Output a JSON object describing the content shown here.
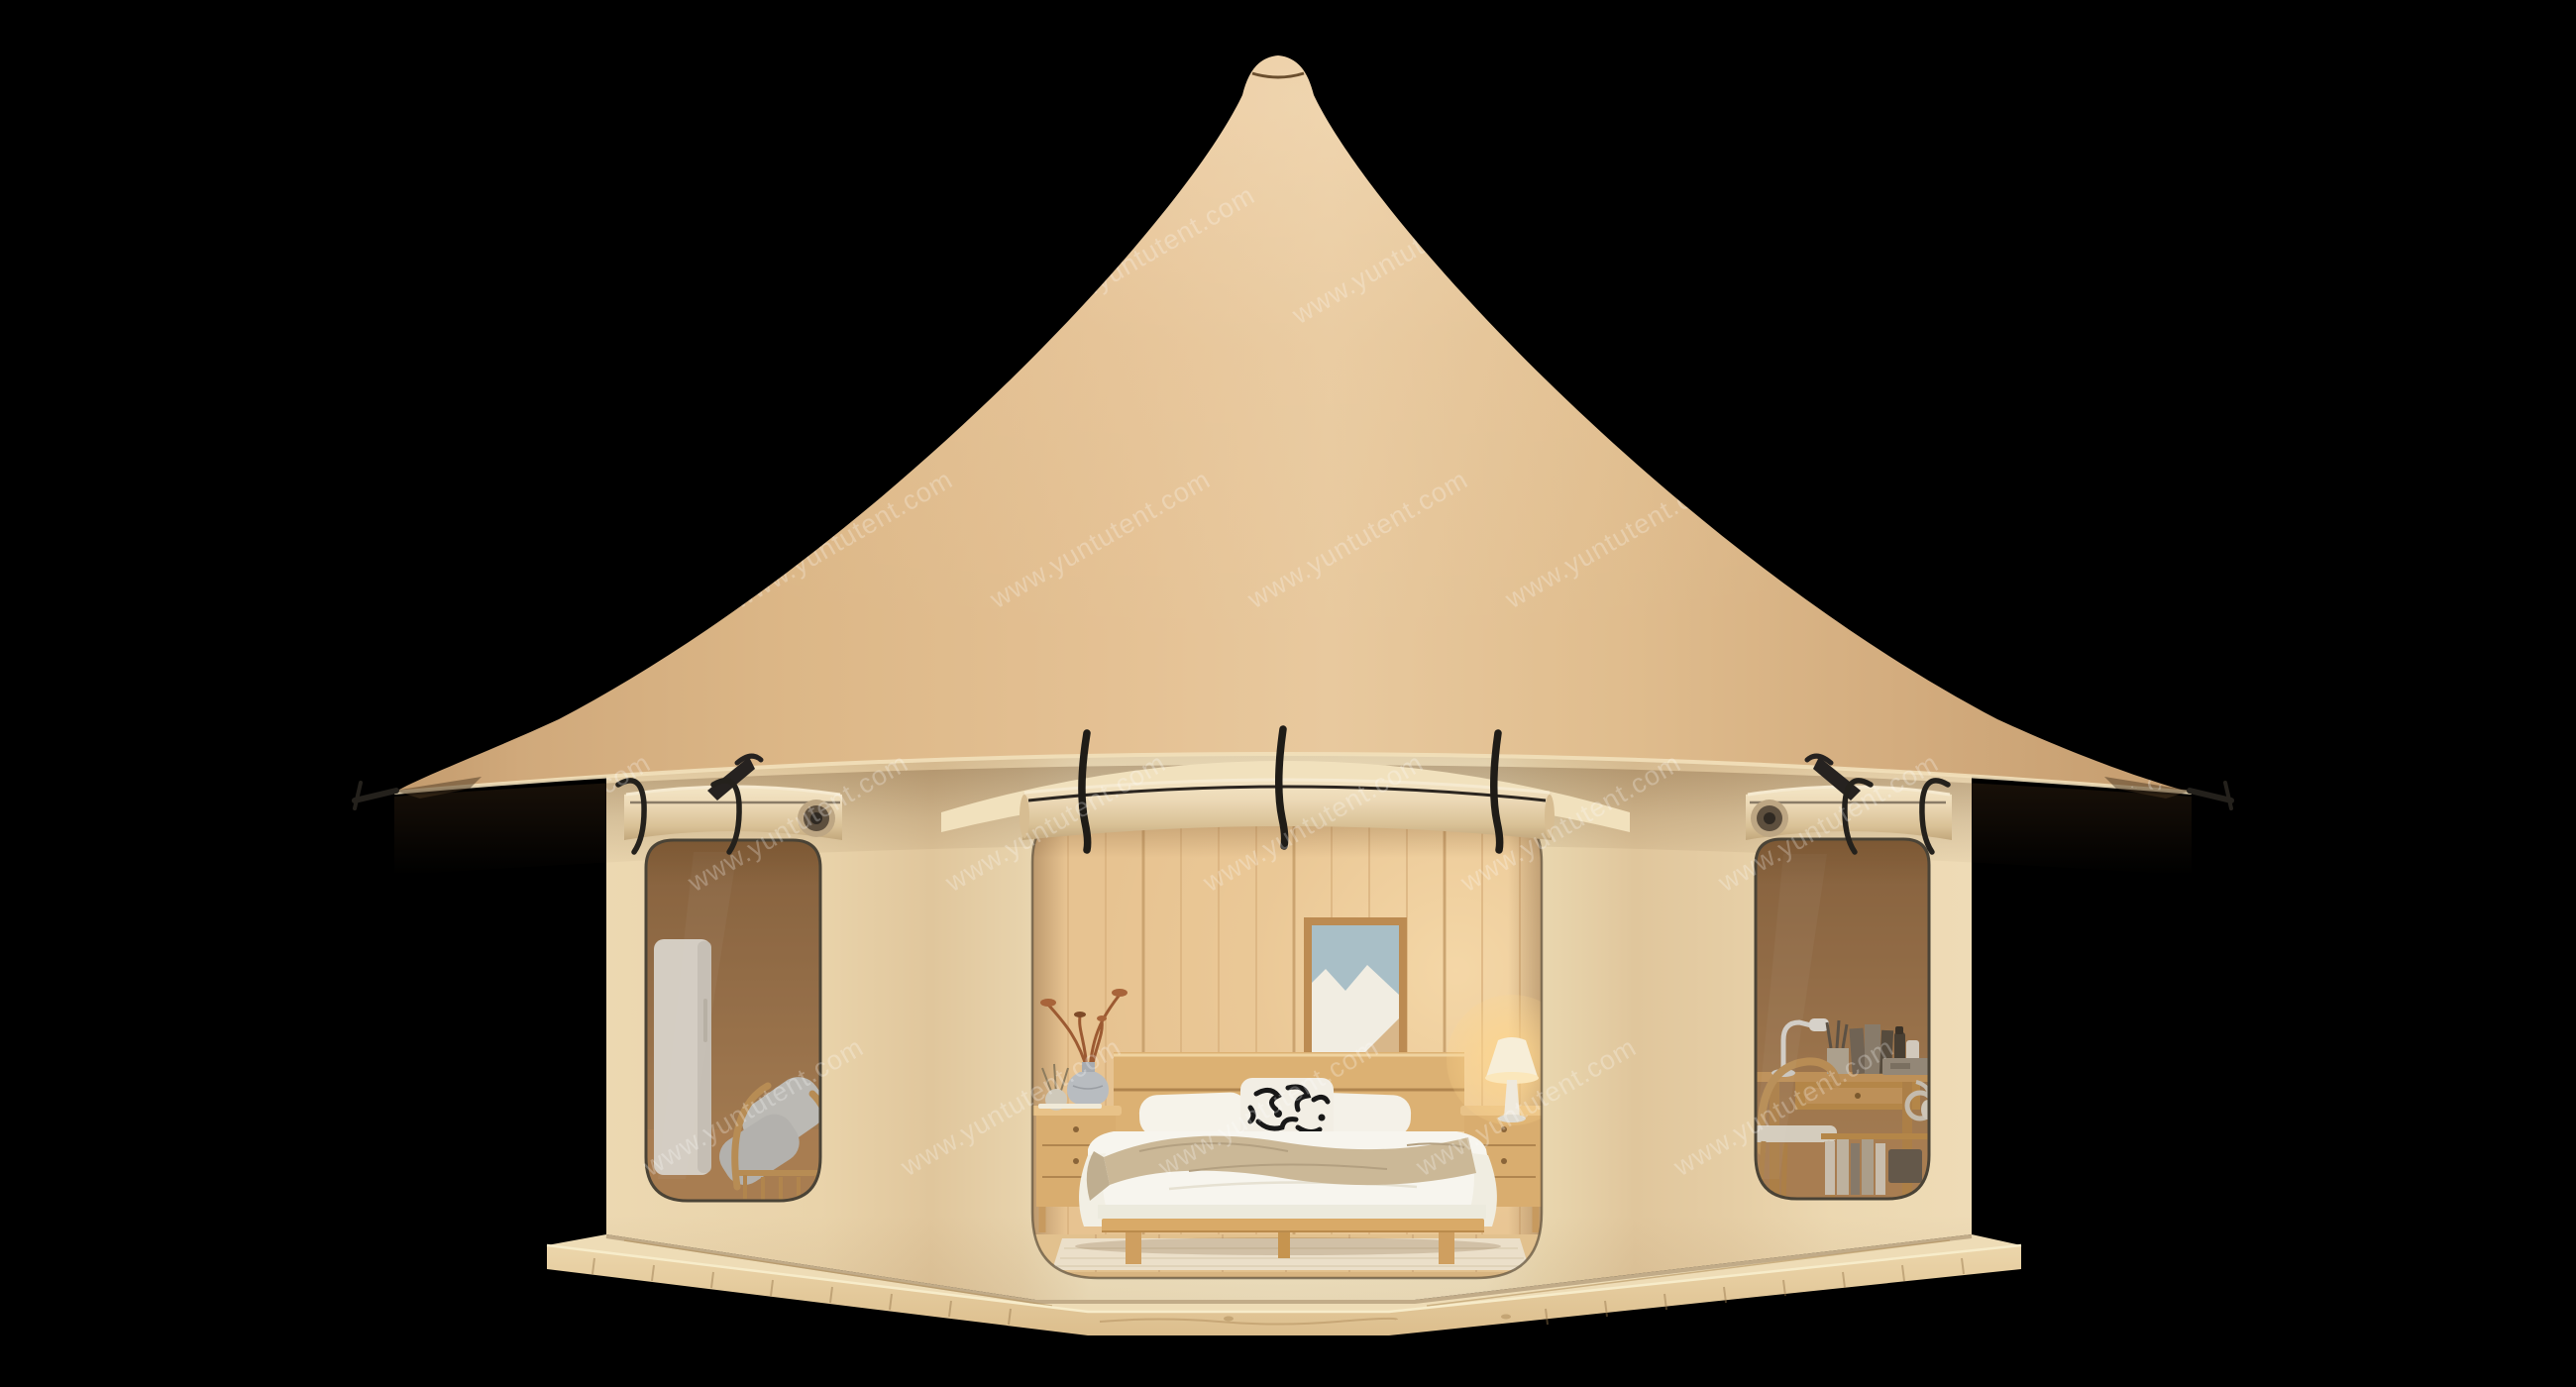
{
  "scene": {
    "type": "3d-product-render",
    "subject": "Luxury glamping yurt-style tent with conical canvas roof, open front doorway revealing a furnished wooden bedroom, two tinted side windows with rolled-up canvas covers, standing on a wooden deck platform against a black background"
  },
  "watermark": {
    "text": "www.yuntutent.com",
    "color": "#ffffff",
    "opacity": 0.26,
    "rotation_deg": -30
  },
  "colors": {
    "background": "#000000",
    "roof_canvas": "#e2bd8e",
    "roof_shadow": "#c49c6e",
    "roof_highlight": "#e8c99e",
    "eave_hem": "#f2e0ba",
    "wall_canvas": "#f1e4c3",
    "wall_shadow": "#e0c69c",
    "eave_underside": "#f1e1bd",
    "rolled_canvas": "#ecd9b6",
    "deck_wood_top": "#eedcb6",
    "deck_wood_face": "#e7d0a2",
    "window_glass": "#9c7450",
    "interior_wood": "#e7c391",
    "metal_fittings": "#24211c",
    "bedding_white": "#f7f4ec",
    "throw_blanket": "#cbb897",
    "accent_pillow_pattern": "#181818",
    "artwork_blue": "#a9bfc7",
    "lamp_glow": "#ffd68c",
    "cushion_grey": "#ccd2d6"
  }
}
